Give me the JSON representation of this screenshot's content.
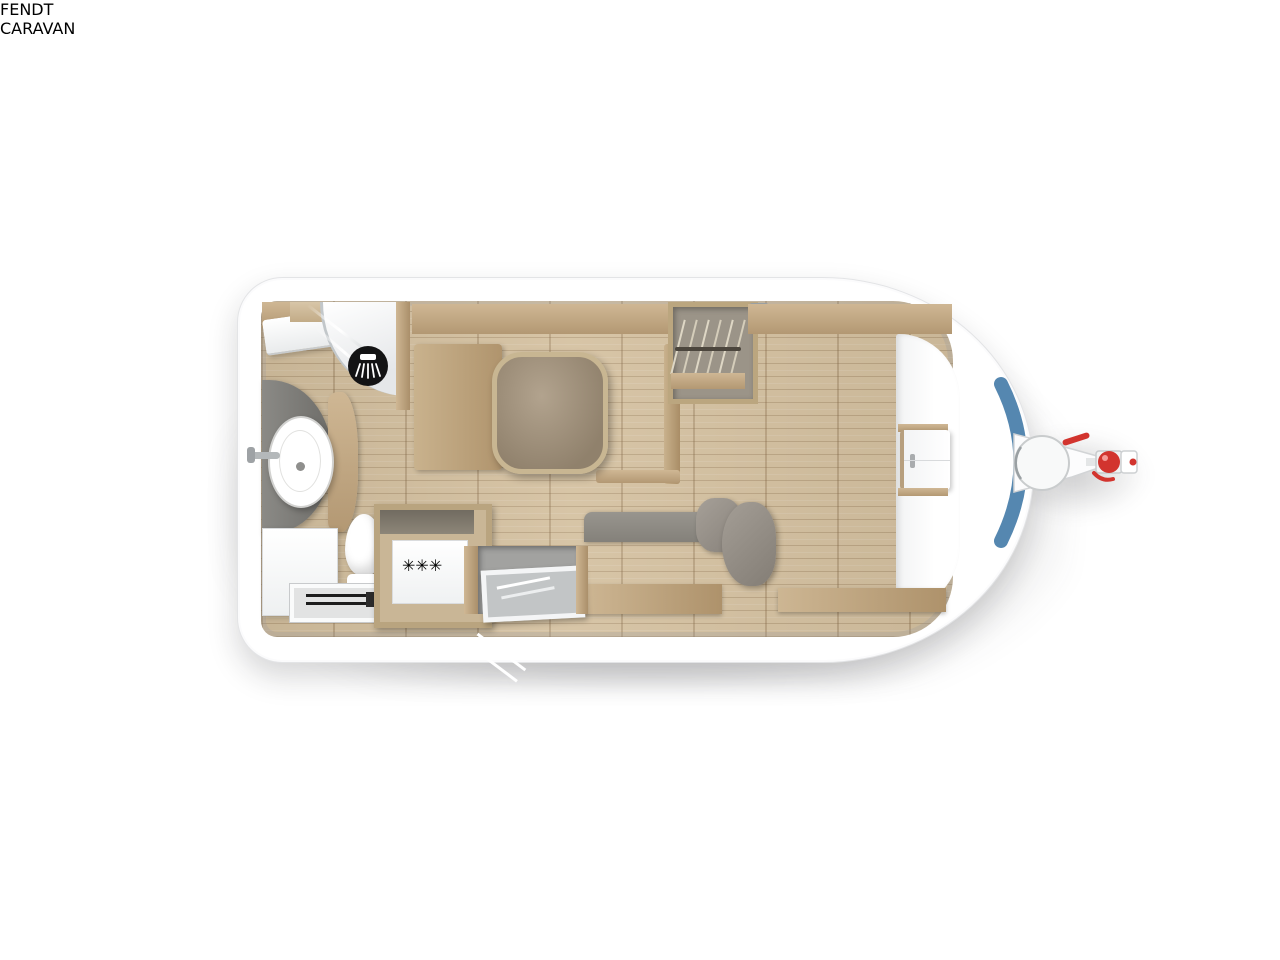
{
  "branding": {
    "brand": "FENDT",
    "sub_brand": "CARAVAN"
  },
  "appliances": {
    "fridge_label": "✳✳✳"
  },
  "icons": {
    "shower": "shower-icon",
    "fridge_rating": "snowflake-rating-icon",
    "hitch": "tow-hitch-icon",
    "hangers": "clothes-hangers-icon"
  },
  "layout": {
    "view": "top-down caravan floor plan",
    "windows_top_wall": 2,
    "windows_bottom_wall": 3,
    "front_window": 1,
    "single_beds": 2
  },
  "colors": {
    "body_white": "#ffffff",
    "window_blue": "#5587b0",
    "window_blue_dark": "#35618c",
    "fendt_blue": "#1a4c7f",
    "hitch_red": "#d2342e",
    "wood": "#c3ad8c",
    "floor": "#d4c09f",
    "plaid_base": "#dcdad5",
    "bed_rim": "#7d8288",
    "cushion_grey": "#9b9791",
    "counter_grey": "#7b7a76",
    "splashback_grey": "#8e8b85",
    "glass_dark": "#17181a"
  }
}
